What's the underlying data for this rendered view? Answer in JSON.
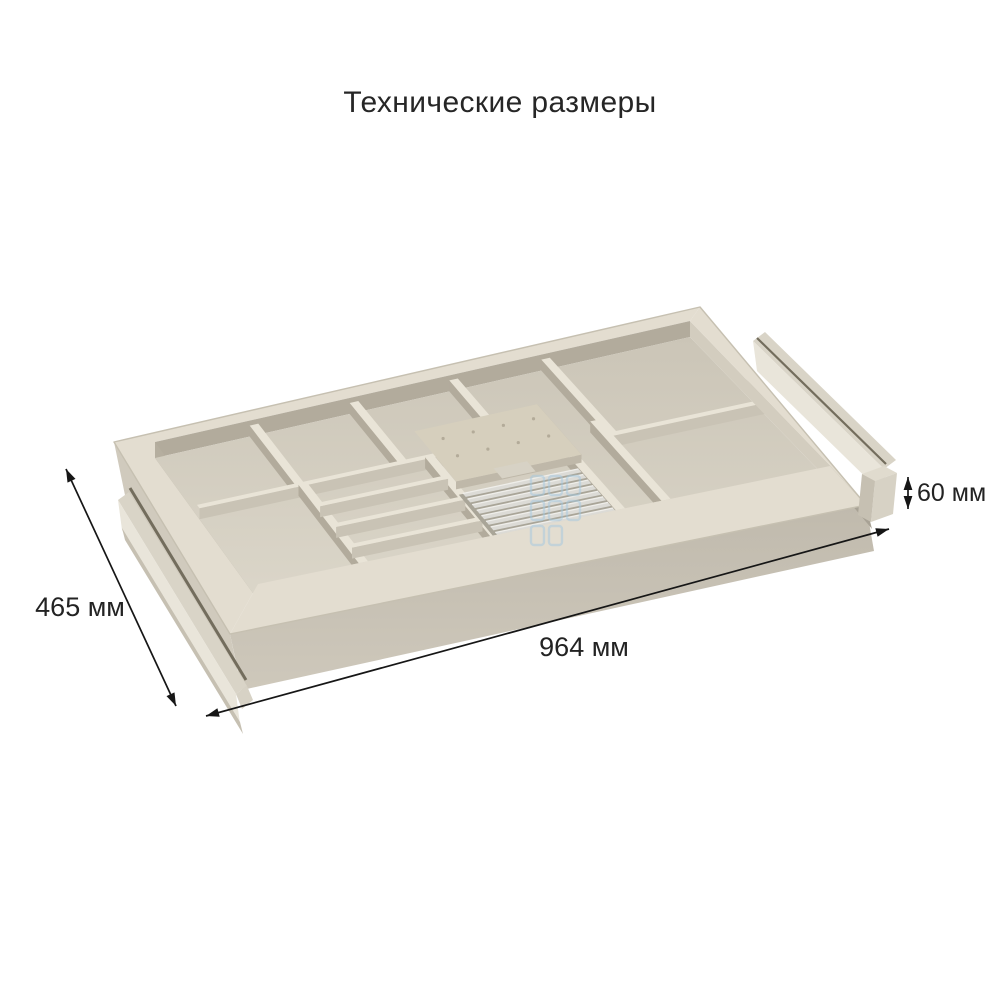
{
  "page": {
    "background": "#ffffff",
    "title": "Технические размеры"
  },
  "dimensions": {
    "depth": {
      "label": "465 мм"
    },
    "length": {
      "label": "964 мм"
    },
    "height": {
      "label": "60 мм"
    }
  },
  "product": {
    "name": "drawer-cutlery-organizer",
    "dividers_u": [
      {
        "u": 0.185,
        "v0": 0,
        "v1": 0.42
      },
      {
        "u": 0.372,
        "v0": 0,
        "v1": 0.42
      },
      {
        "u": 0.558,
        "v0": 0,
        "v1": 0.42
      },
      {
        "u": 0.73,
        "v0": 0,
        "v1": 0.52
      },
      {
        "u": 0.19,
        "v0": 0.42,
        "v1": 1
      },
      {
        "u": 0.42,
        "v0": 0.42,
        "v1": 1
      },
      {
        "u": 0.64,
        "v0": 0.42,
        "v1": 1
      },
      {
        "u": 0.72,
        "v0": 0.42,
        "v1": 1
      }
    ],
    "dividers_v": [
      {
        "v": 0.42,
        "u0": 0,
        "u1": 0.64
      },
      {
        "v": 0.52,
        "u0": 0.72,
        "u1": 1
      },
      {
        "v": 0.565,
        "u0": 0.19,
        "u1": 0.42
      },
      {
        "v": 0.71,
        "u0": 0.19,
        "u1": 0.42
      },
      {
        "v": 0.855,
        "u0": 0.19,
        "u1": 0.42
      }
    ],
    "knife_board": {
      "u0": 0.425,
      "u1": 0.65,
      "v0": 0.27,
      "v1": 0.62
    },
    "board_tab": {
      "u0": 0.5,
      "u1": 0.56,
      "v0": 0.585,
      "v1": 0.655
    },
    "rib_holder": {
      "u0": 0.43,
      "u1": 0.645,
      "v0": 0.62,
      "v1": 1.0,
      "ribs": 9
    }
  },
  "colors": {
    "background": "#ffffff",
    "text": "#232323",
    "dimension_line": "#161616",
    "rim_top": "#e3ddd0",
    "rim_edge": "#c6c0b1",
    "floor_light": "#dbd6c9",
    "floor_dark": "#cbc5b7",
    "wall_top": "#e9e4d7",
    "wall_side_dark": "#b2ab9c",
    "wall_side_mid": "#c9c3b5",
    "band_back": "#b2ab9c",
    "band_left": "#b5ae9f",
    "band_front": "#d9d3c6",
    "band_right": "#d3cdbf",
    "face_left": "#d0cabd",
    "face_front_top": "#c0baad",
    "face_front_bottom": "#cec8bb",
    "gap_dark": "#a8a295",
    "rail_top": "#d9d4c7",
    "rail_face": "#e9e5da",
    "rail_gap": "#736d5d",
    "cap_top": "#e0dbce",
    "cap_face": "#d7d2c5",
    "cap_side": "#c6c0b2",
    "board": "#d6cfbd",
    "board_side": "#bfb8a9",
    "board_dot": "#b3ab99",
    "rib_base": "#a9a598",
    "rib": "#dcdbd6",
    "rib_highlight": "#efeeea",
    "watermark": "#a5c9e0"
  }
}
